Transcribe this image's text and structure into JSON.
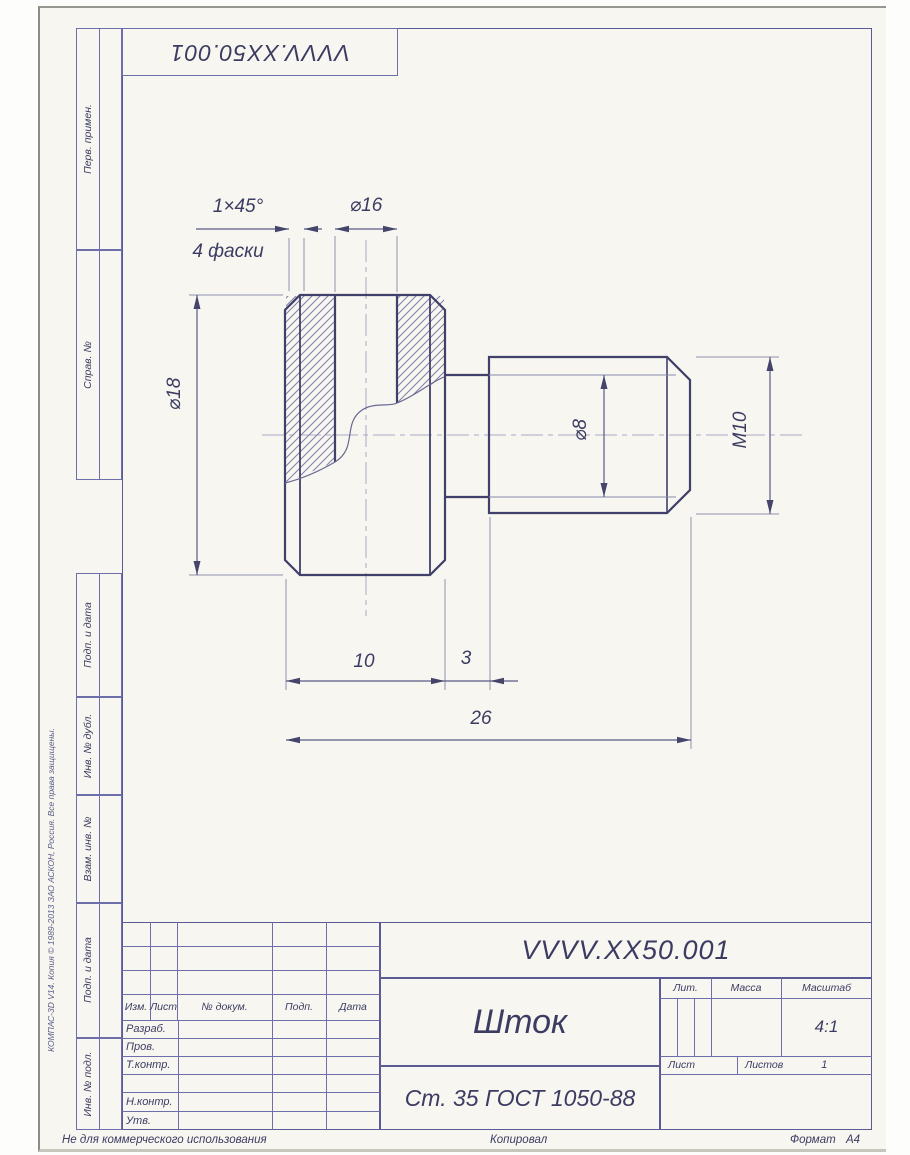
{
  "corner_stamp": {
    "designation": "VVVV.XX50.001"
  },
  "margin_graphs": {
    "g1": "Перв. примен.",
    "g2": "Справ. №",
    "g3": "Подп. и дата",
    "g4": "Инв. № дубл.",
    "g5": "Взам. инв. №",
    "g6": "Подп. и дата",
    "g7": "Инв. № подл.",
    "copyright": "КОМПАС-3D V14. Копия © 1989-2013 ЗАО АСКОН, Россия. Все права защищены."
  },
  "dimensions": {
    "chamfer": "1×45°",
    "chamfer_count": "4 фаски",
    "dia16": "⌀16",
    "dia18": "⌀18",
    "dia8": "⌀8",
    "thread": "M10",
    "len_head": "10",
    "len_groove": "3",
    "len_total": "26"
  },
  "title_block": {
    "designation": "VVVV.XX50.001",
    "part_name": "Шток",
    "material": "Ст. 35 ГОСТ 1050-88",
    "col_izm": "Изм.",
    "col_list": "Лист",
    "col_doc": "№ докум.",
    "col_podp": "Подп.",
    "col_data": "Дата",
    "row_razrab": "Разраб.",
    "row_prov": "Пров.",
    "row_tkontr": "Т.контр.",
    "row_nkontr": "Н.контр.",
    "row_utv": "Утв.",
    "lit_label": "Лит.",
    "mass_label": "Масса",
    "scale_label": "Масштаб",
    "scale_value": "4:1",
    "sheet_label": "Лист",
    "sheets_label": "Листов",
    "sheets_value": "1"
  },
  "footer": {
    "note": "Не для коммерческого использования",
    "copied": "Копировал",
    "format_label": "Формат",
    "format_value": "А4"
  }
}
